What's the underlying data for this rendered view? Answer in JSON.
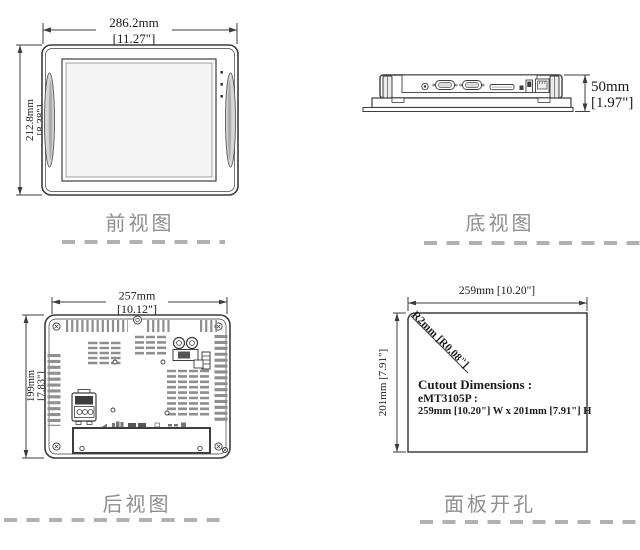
{
  "views": {
    "front": {
      "label": "前视图",
      "width_mm": "286.2mm",
      "width_in": "[11.27\"]",
      "height_mm": "212.8mm",
      "height_in": "[8.38\"]"
    },
    "bottom": {
      "label": "底视图",
      "height_mm": "50mm",
      "height_in": "[1.97\"]"
    },
    "rear": {
      "label": "后视图",
      "width_mm": "257mm",
      "width_in": "[10.12\"]",
      "height_mm": "199mm",
      "height_in": "[7.83\"]"
    },
    "cutout": {
      "label": "面板开孔",
      "width": "259mm [10.20\"]",
      "height": "201mm [7.91\"]",
      "corner_radius": "R2mm [R0.08\"]",
      "note1": "Cutout Dimensions :",
      "note2": "eMT3105P :",
      "note3": "259mm [10.20\"] W x 201mm [7.91\"] H"
    }
  },
  "colors": {
    "line": "#3d3d3d",
    "dim_text": "#1a1a1a",
    "label_text": "#8f8f8f",
    "dash": "#b1b1b1",
    "screen_fill": "#f4f4f4",
    "vent": "#8f8f8f"
  }
}
